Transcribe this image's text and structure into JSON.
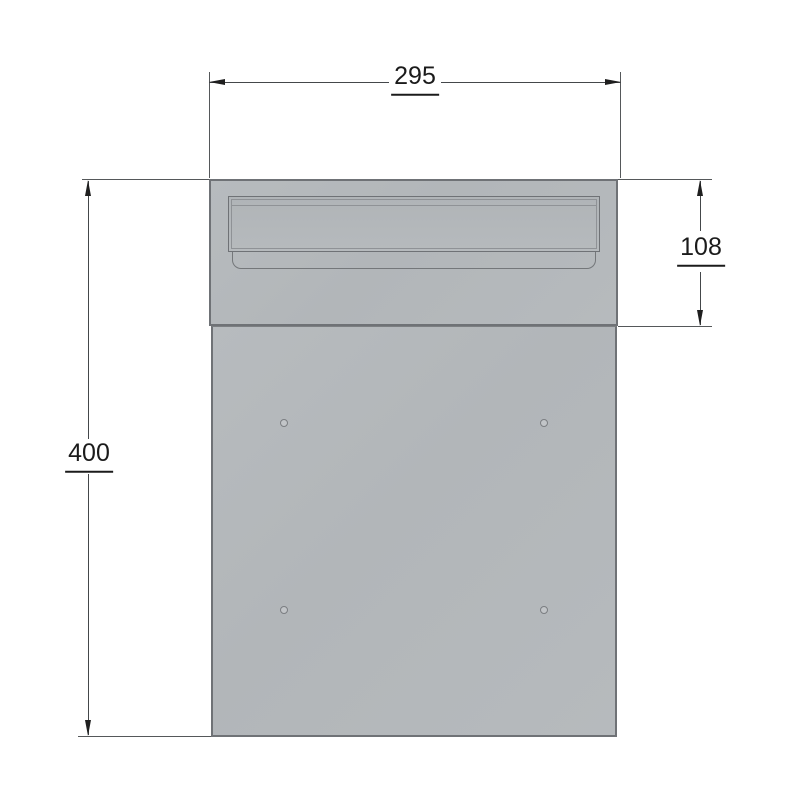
{
  "drawing": {
    "description": "Technical drawing of letterbox front panel with letter slot flap and four screw holes",
    "dimensions": {
      "width": "295",
      "height": "400",
      "slot_section_height": "108"
    },
    "colors": {
      "background": "#ffffff",
      "panel_fill": "#b4b8bb",
      "panel_border": "#6f7276",
      "slot_line": "#8f9296",
      "dimension_line": "#44474a",
      "dimension_text": "#1b1b1b"
    }
  }
}
